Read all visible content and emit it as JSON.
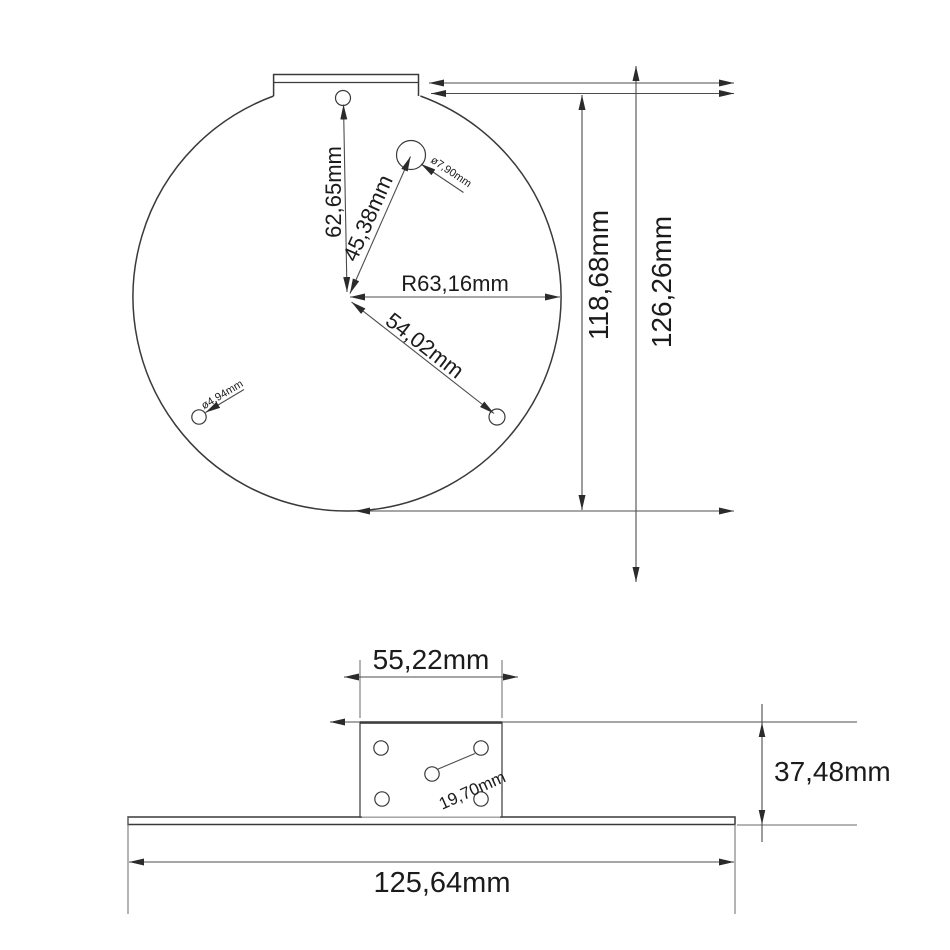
{
  "title": "bracket-technical-drawing",
  "colors": {
    "background": "#ffffff",
    "outline": "#3a3a3a",
    "dimension_lines": "#4d4d4d",
    "text": "#1b1b1b"
  },
  "top_view": {
    "dims": {
      "hole_top_offset": "62,65mm",
      "hole_upper_right_offset": "45,38mm",
      "radius": "R63,16mm",
      "hole_lower_right_offset": "54,02mm",
      "dia_upper_right_hole": "ø7,90mm",
      "dia_lower_left_hole": "ø4,94mm",
      "height_disc": "118,68mm",
      "height_total": "126,26mm"
    }
  },
  "side_view": {
    "dims": {
      "post_width": "55,22mm",
      "hole_spacing": "19,70mm",
      "post_height": "37,48mm",
      "base_width": "125,64mm"
    }
  }
}
